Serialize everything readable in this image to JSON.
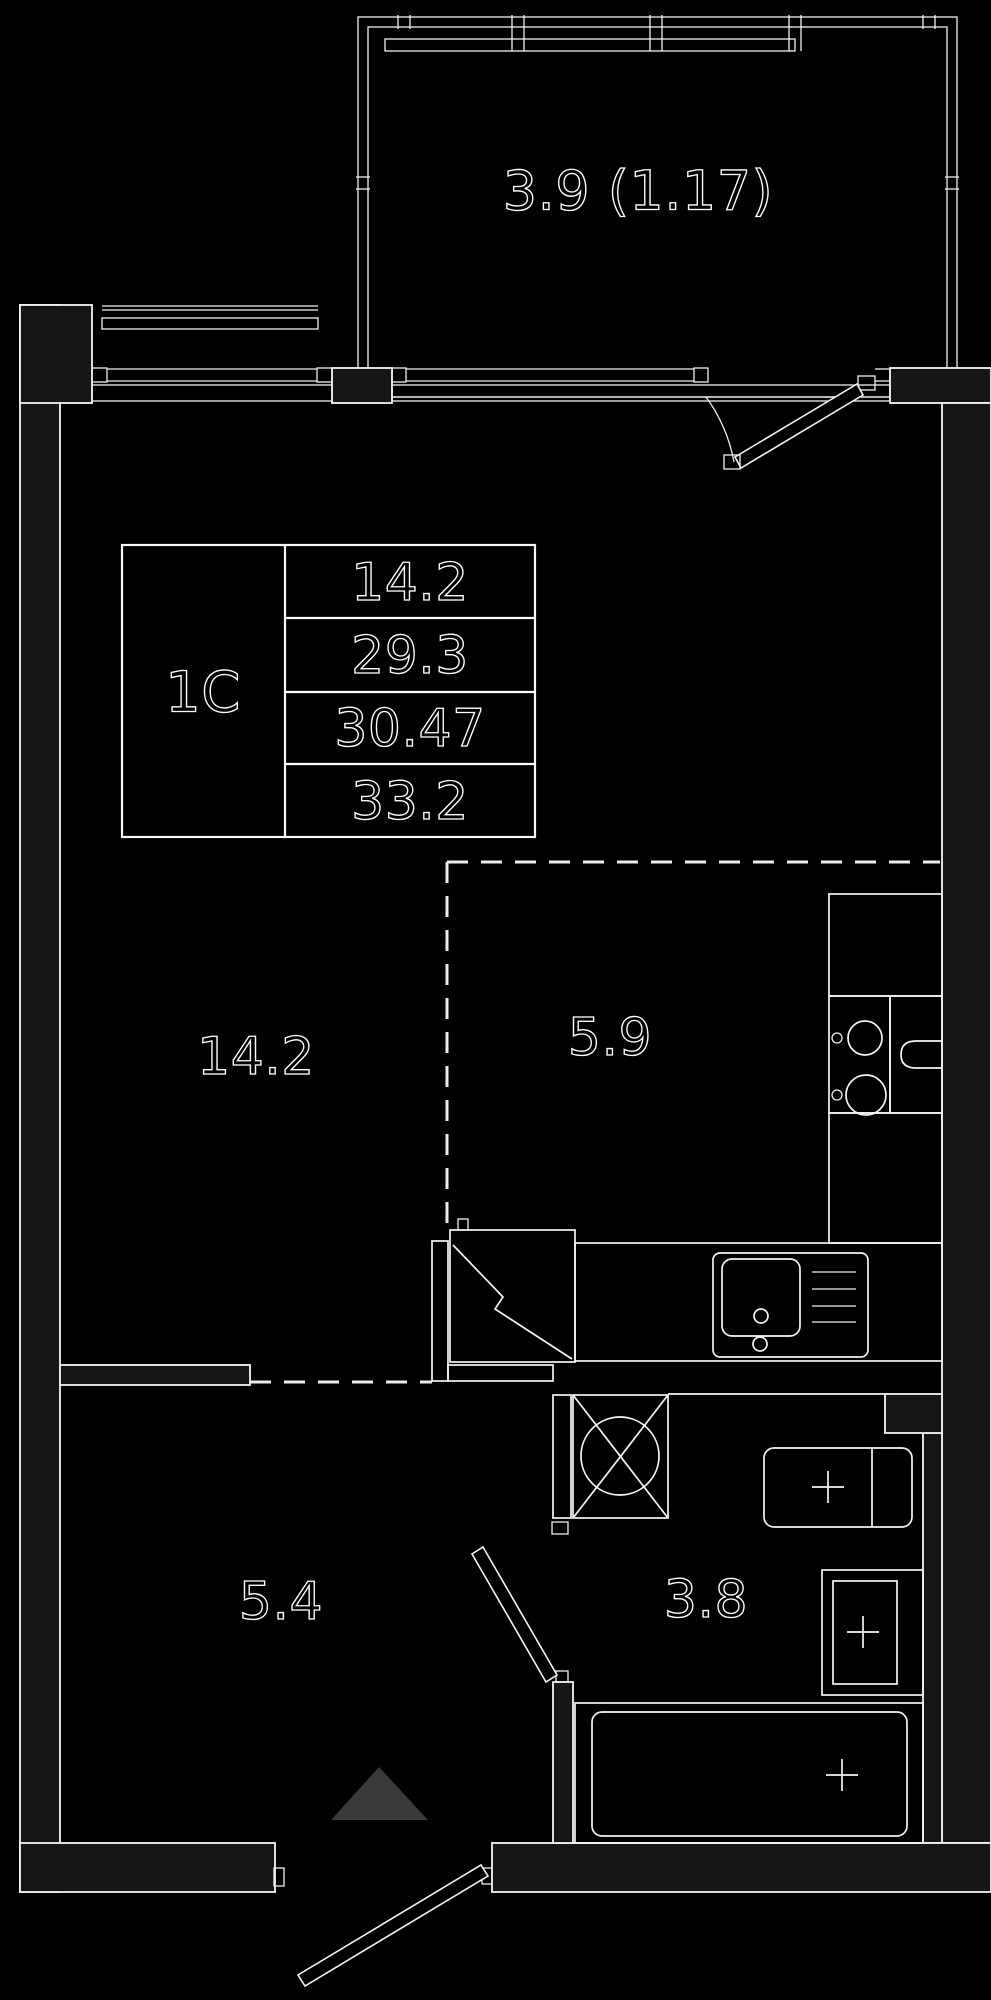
{
  "floor_plan": {
    "unit_type_label": "1С",
    "spec_table": {
      "unit_label": "1С",
      "values": [
        "14.2",
        "29.3",
        "30.47",
        "33.2"
      ]
    },
    "labels": {
      "balcony": "3.9 (1.17)",
      "living_room": "14.2",
      "kitchen": "5.9",
      "hallway": "5.4",
      "bathroom": "3.8"
    },
    "colors": {
      "background": "#000000",
      "wall_fill": "#161616",
      "line": "#f5f5f5",
      "entry_arrow": "#3a3a3a"
    },
    "icons": [
      "stove-burners-icon",
      "kitchen-sink-icon",
      "vent-shaft-icon",
      "washing-machine-icon",
      "washbasin-icon",
      "toilet-icon",
      "bathtub-icon",
      "entry-arrow-icon",
      "door-swing-icon"
    ]
  }
}
